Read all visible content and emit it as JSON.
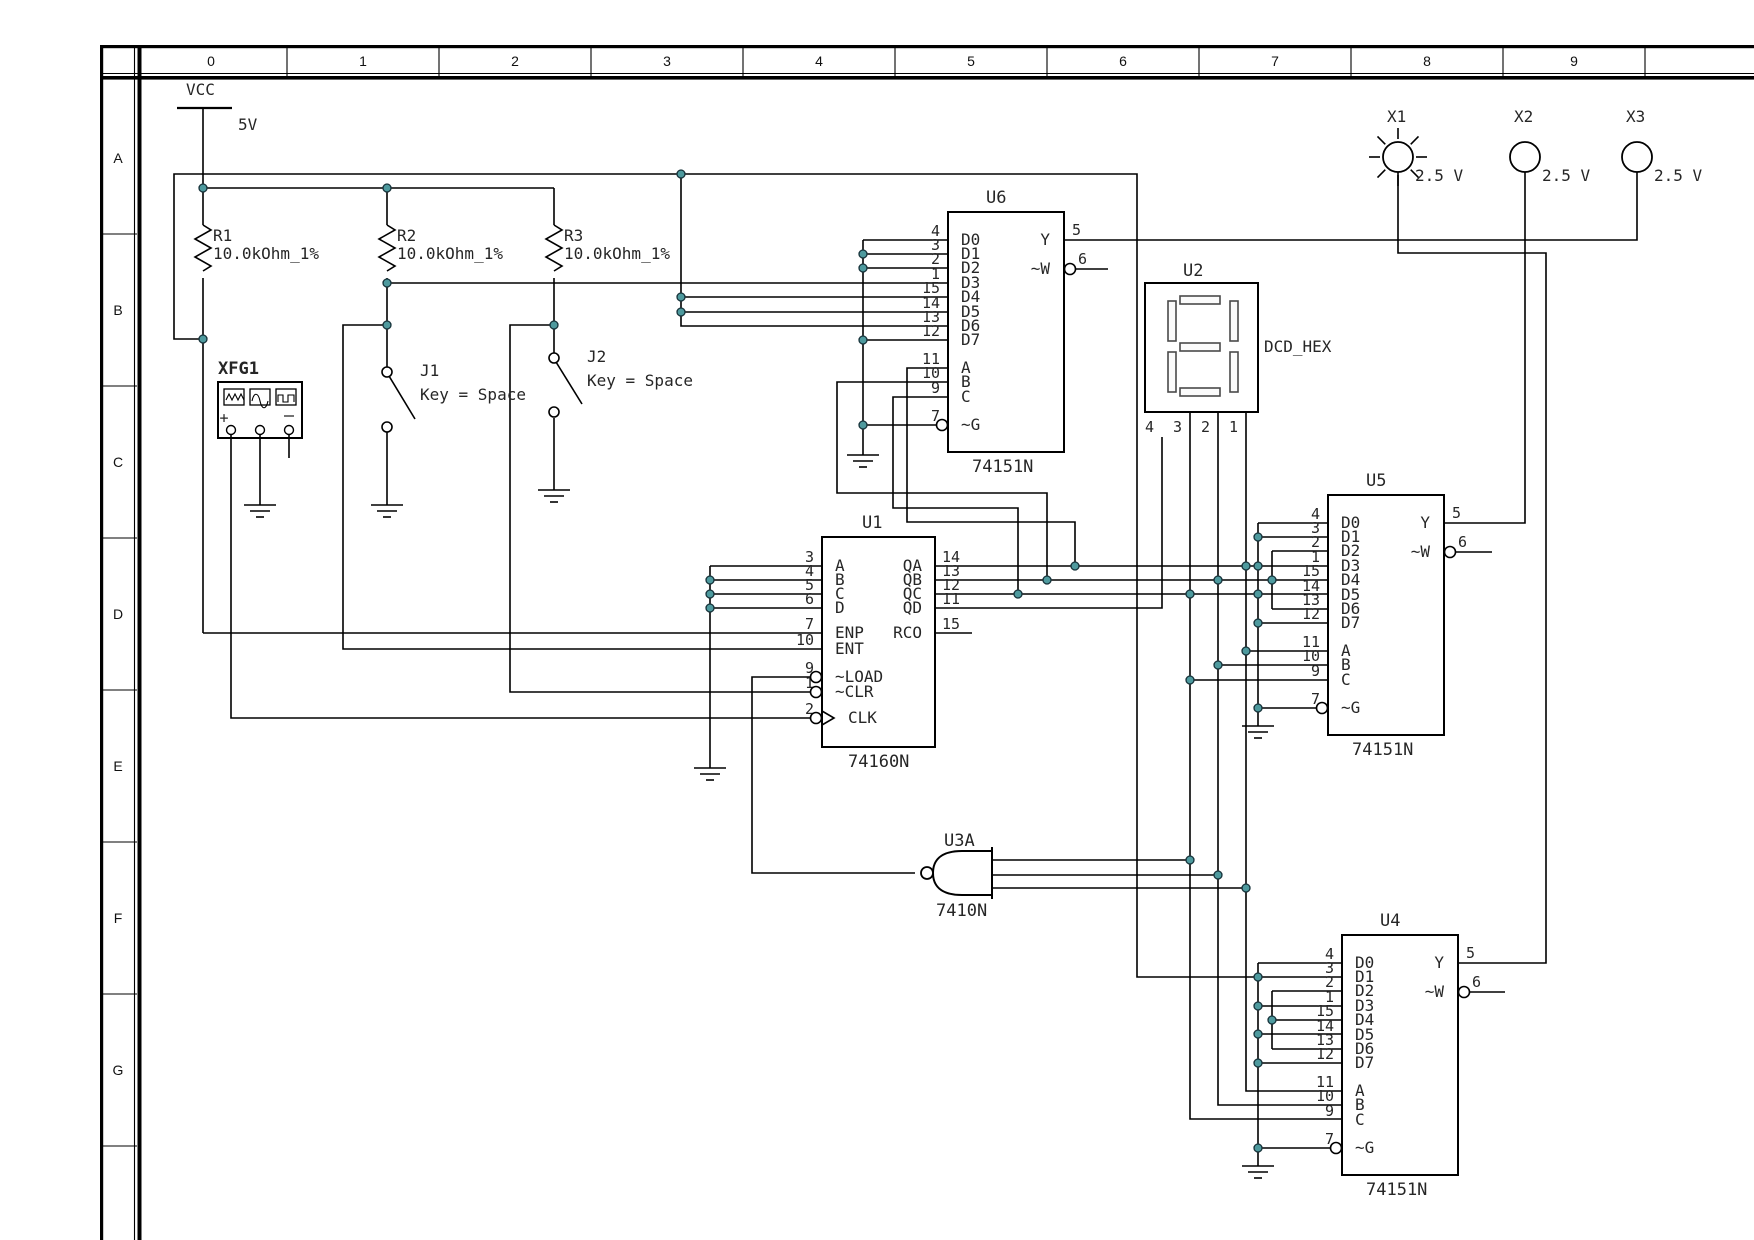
{
  "colors": {
    "wire": "#000000",
    "text": "#262626",
    "junction_fill": "#4e9a9e",
    "junction_stroke": "#16323a",
    "background": "#ffffff",
    "segment_fill": "#fbfbfb",
    "segment_stroke": "#4a4a4a"
  },
  "grid": {
    "columns": [
      "0",
      "1",
      "2",
      "3",
      "4",
      "5",
      "6",
      "7",
      "8",
      "9"
    ],
    "rows": [
      "A",
      "B",
      "C",
      "D",
      "E",
      "F",
      "G"
    ]
  },
  "power": {
    "label": "VCC",
    "value": "5V"
  },
  "resistors": [
    {
      "ref": "R1",
      "value": "10.0kOhm_1%"
    },
    {
      "ref": "R2",
      "value": "10.0kOhm_1%"
    },
    {
      "ref": "R3",
      "value": "10.0kOhm_1%"
    }
  ],
  "function_generator": {
    "ref": "XFG1",
    "plus_label": "+",
    "minus_label": "−"
  },
  "switches": [
    {
      "ref": "J1",
      "key": "Key = Space"
    },
    {
      "ref": "J2",
      "key": "Key = Space"
    }
  ],
  "muxes": [
    {
      "id": "u6",
      "ref": "U6",
      "part": "74151N",
      "data_pins": [
        [
          "4",
          "D0"
        ],
        [
          "3",
          "D1"
        ],
        [
          "2",
          "D2"
        ],
        [
          "1",
          "D3"
        ],
        [
          "15",
          "D4"
        ],
        [
          "14",
          "D5"
        ],
        [
          "13",
          "D6"
        ],
        [
          "12",
          "D7"
        ]
      ],
      "select_pins": [
        [
          "11",
          "A"
        ],
        [
          "10",
          "B"
        ],
        [
          "9",
          "C"
        ]
      ],
      "enable_pin": [
        "7",
        "~G"
      ],
      "output_pins": [
        [
          "5",
          "Y"
        ],
        [
          "6",
          "~W"
        ]
      ]
    },
    {
      "id": "u5",
      "ref": "U5",
      "part": "74151N",
      "data_pins": [
        [
          "4",
          "D0"
        ],
        [
          "3",
          "D1"
        ],
        [
          "2",
          "D2"
        ],
        [
          "1",
          "D3"
        ],
        [
          "15",
          "D4"
        ],
        [
          "14",
          "D5"
        ],
        [
          "13",
          "D6"
        ],
        [
          "12",
          "D7"
        ]
      ],
      "select_pins": [
        [
          "11",
          "A"
        ],
        [
          "10",
          "B"
        ],
        [
          "9",
          "C"
        ]
      ],
      "enable_pin": [
        "7",
        "~G"
      ],
      "output_pins": [
        [
          "5",
          "Y"
        ],
        [
          "6",
          "~W"
        ]
      ]
    },
    {
      "id": "u4",
      "ref": "U4",
      "part": "74151N",
      "data_pins": [
        [
          "4",
          "D0"
        ],
        [
          "3",
          "D1"
        ],
        [
          "2",
          "D2"
        ],
        [
          "1",
          "D3"
        ],
        [
          "15",
          "D4"
        ],
        [
          "14",
          "D5"
        ],
        [
          "13",
          "D6"
        ],
        [
          "12",
          "D7"
        ]
      ],
      "select_pins": [
        [
          "11",
          "A"
        ],
        [
          "10",
          "B"
        ],
        [
          "9",
          "C"
        ]
      ],
      "enable_pin": [
        "7",
        "~G"
      ],
      "output_pins": [
        [
          "5",
          "Y"
        ],
        [
          "6",
          "~W"
        ]
      ]
    }
  ],
  "counter": {
    "ref": "U1",
    "part": "74160N",
    "left_pins": [
      [
        "3",
        "A"
      ],
      [
        "4",
        "B"
      ],
      [
        "5",
        "C"
      ],
      [
        "6",
        "D"
      ],
      [
        "7",
        "ENP"
      ],
      [
        "10",
        "ENT"
      ],
      [
        "9",
        "~LOAD"
      ],
      [
        "1",
        "~CLR"
      ],
      [
        "2",
        "CLK"
      ]
    ],
    "right_pins": [
      [
        "14",
        "QA"
      ],
      [
        "13",
        "QB"
      ],
      [
        "12",
        "QC"
      ],
      [
        "11",
        "QD"
      ],
      [
        "15",
        "RCO"
      ]
    ]
  },
  "gate": {
    "ref": "U3A",
    "part": "7410N"
  },
  "display": {
    "ref": "U2",
    "part": "DCD_HEX",
    "pins": [
      "4",
      "3",
      "2",
      "1"
    ]
  },
  "lamps": [
    {
      "ref": "X1",
      "value": "2.5 V",
      "lit": true
    },
    {
      "ref": "X2",
      "value": "2.5 V",
      "lit": false
    },
    {
      "ref": "X3",
      "value": "2.5 V",
      "lit": false
    }
  ]
}
